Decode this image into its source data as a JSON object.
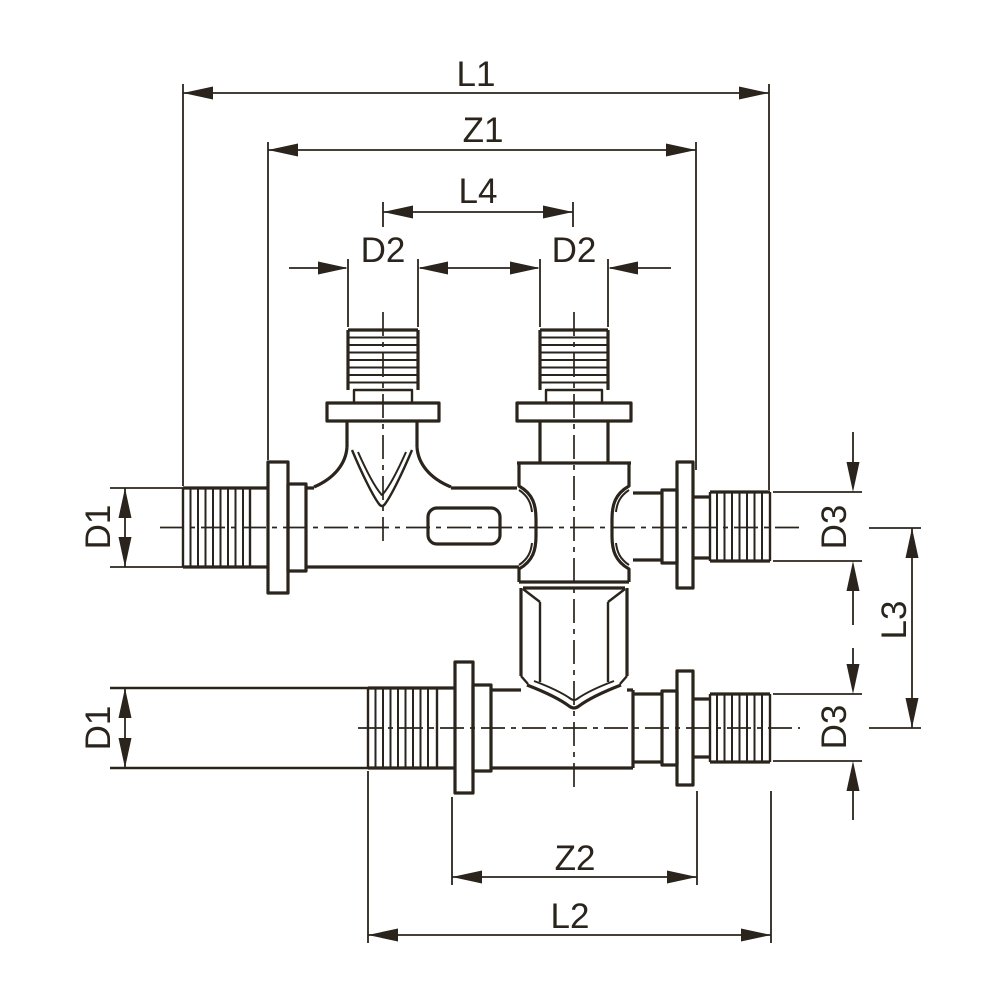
{
  "drawing": {
    "description": "Technical dimensioned line drawing of a double-tee crossing pipe fitting with two vertical threaded spigots and two horizontal threaded pipe runs",
    "line_color": "#2a241c",
    "background_color": "#ffffff",
    "labels": {
      "l1": "L1",
      "z1": "Z1",
      "l4": "L4",
      "d2_left": "D2",
      "d2_right": "D2",
      "d1_upper": "D1",
      "d1_lower": "D1",
      "d3_upper": "D3",
      "d3_lower": "D3",
      "l3": "L3",
      "z2": "Z2",
      "l2": "L2"
    }
  }
}
